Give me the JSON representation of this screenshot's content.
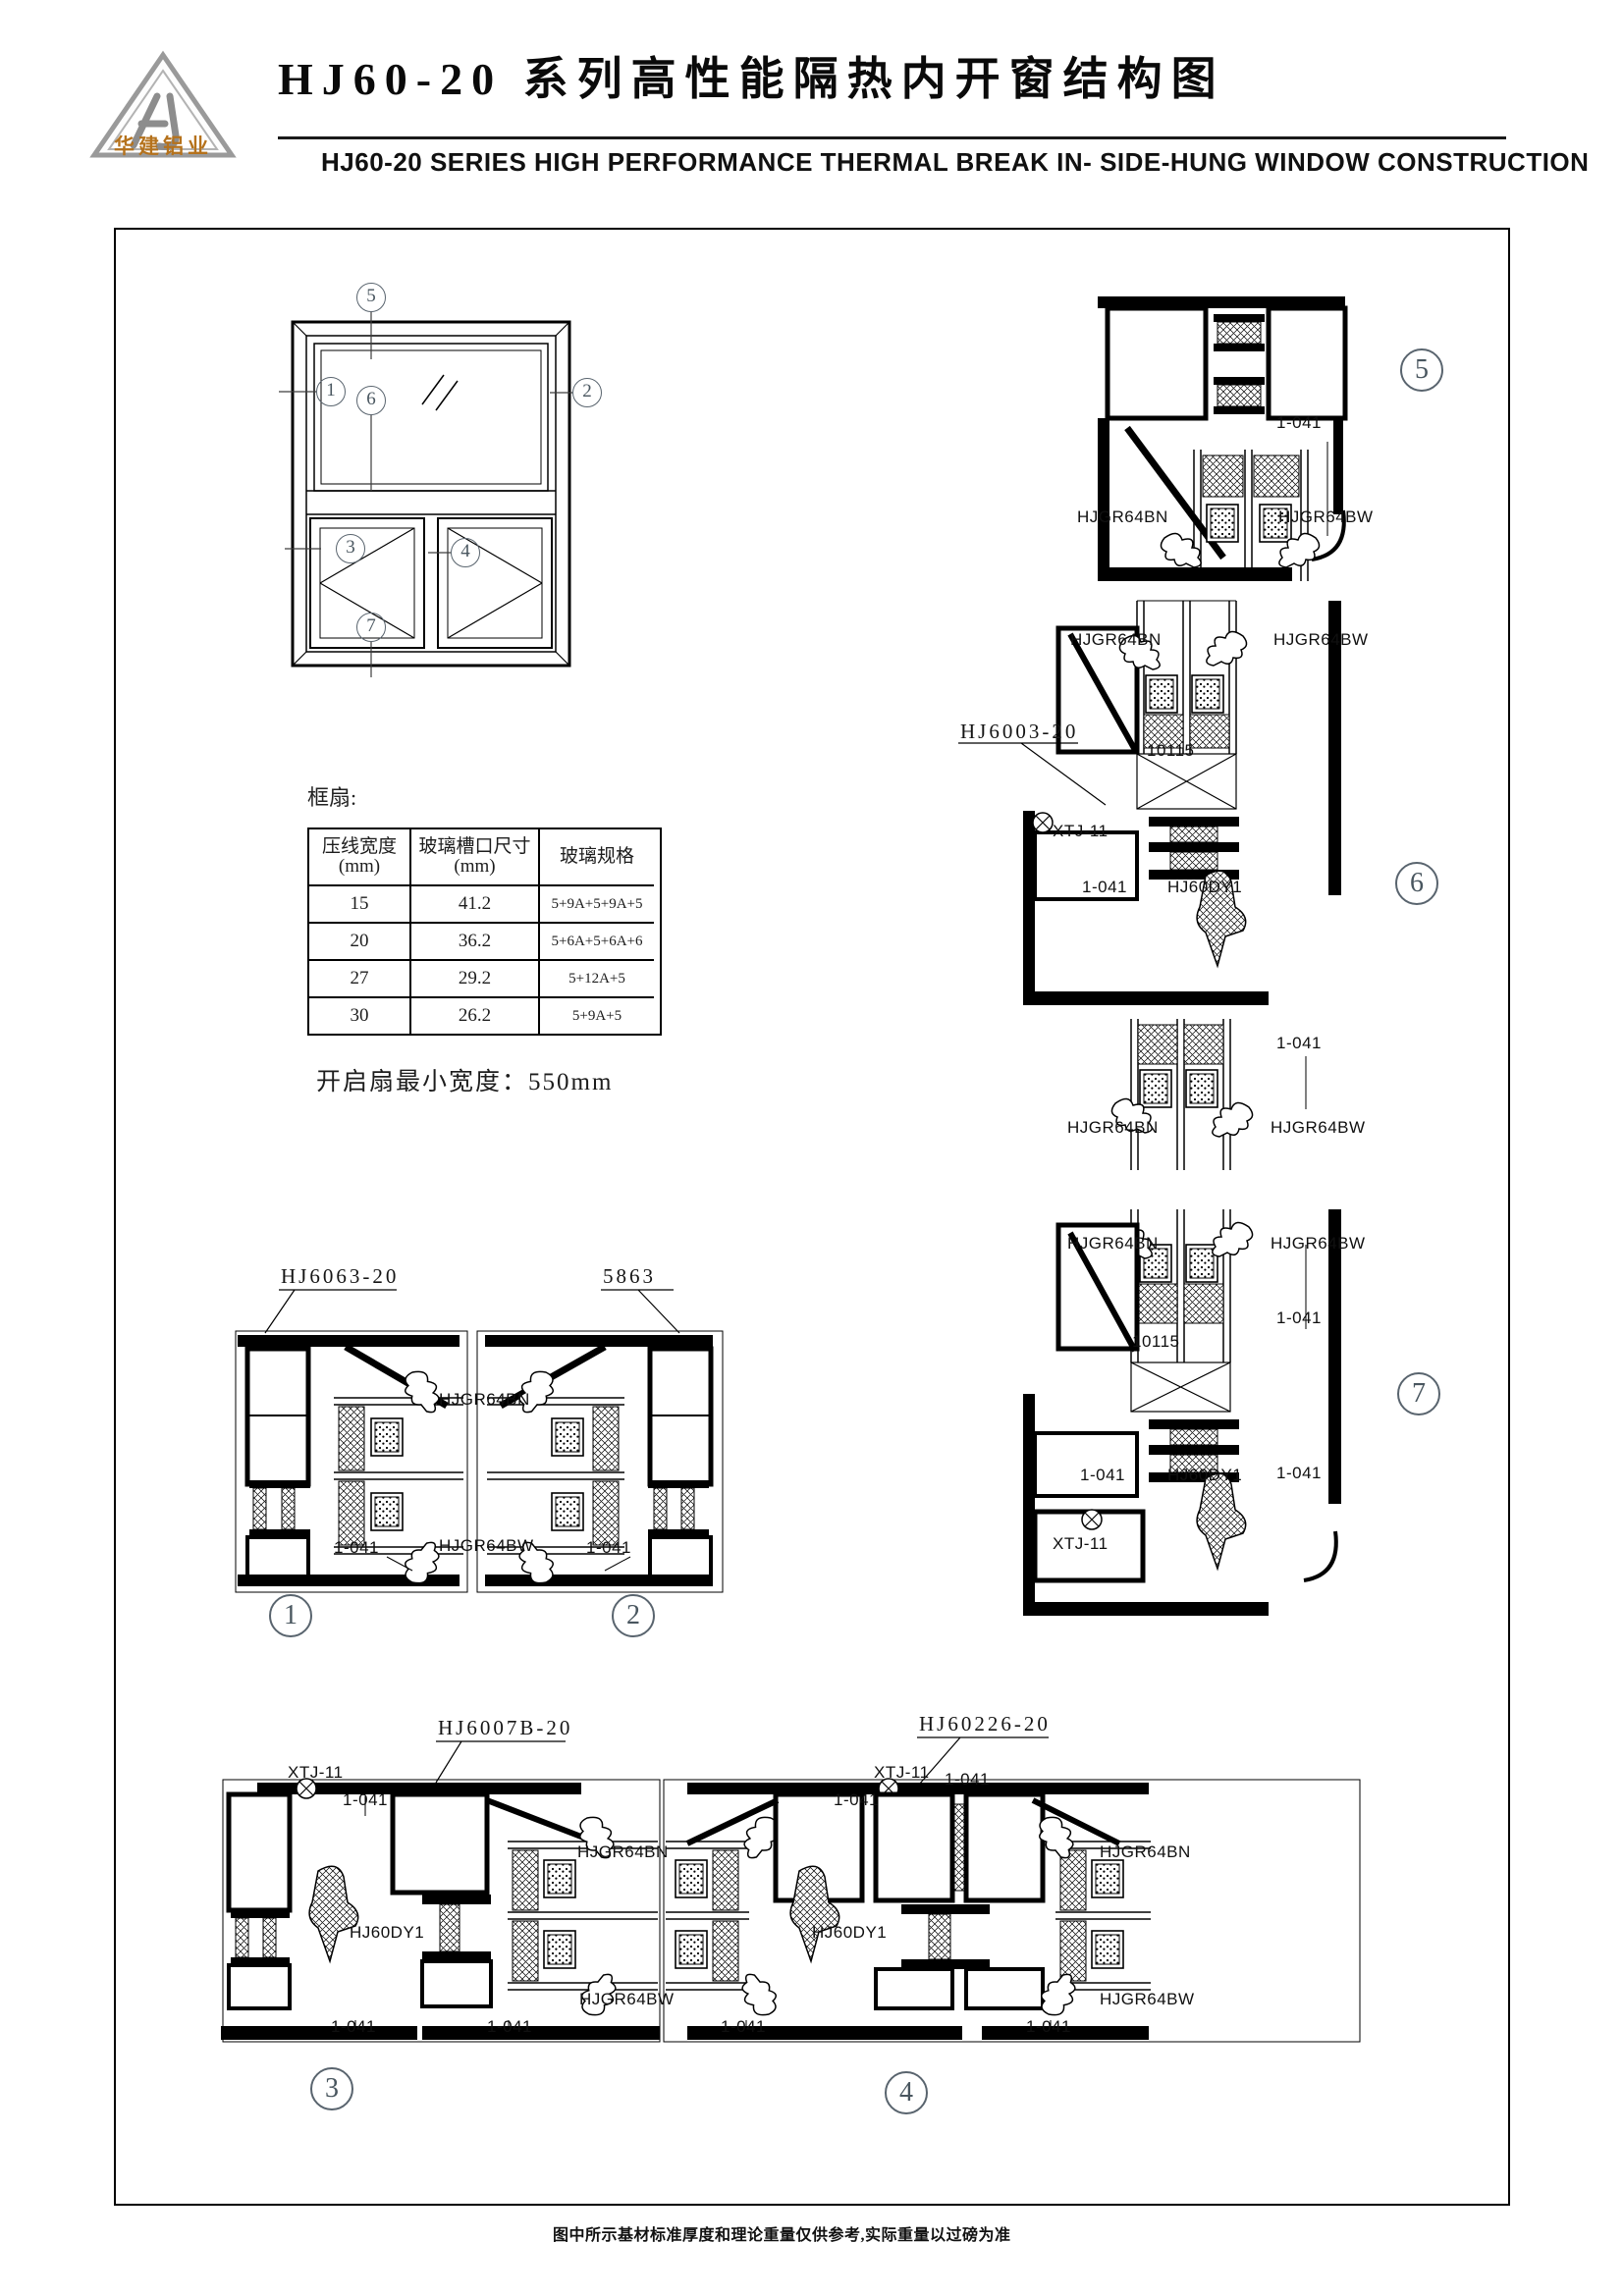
{
  "colors": {
    "ink": "#000000",
    "logo_accent": "#b5721c",
    "callout": "#4b5761"
  },
  "header": {
    "logo_monogram": "HJ",
    "logo_caption": "华建铝业",
    "title_cn": "HJ60-20 系列高性能隔热内开窗结构图",
    "title_en": "HJ60-20 SERIES HIGH PERFORMANCE THERMAL BREAK IN- SIDE-HUNG WINDOW CONSTRUCTION"
  },
  "elevation_callouts": {
    "c1": "1",
    "c2": "2",
    "c3": "3",
    "c4": "4",
    "c5": "5",
    "c6": "6",
    "c7": "7"
  },
  "detail_callouts": {
    "c1": "1",
    "c2": "2",
    "c3": "3",
    "c4": "4",
    "c5": "5",
    "c6": "6",
    "c7": "7"
  },
  "spec_table": {
    "section_label": "框扇:",
    "headers": [
      {
        "title": "压线宽度",
        "unit": "(mm)"
      },
      {
        "title": "玻璃槽口尺寸",
        "unit": "(mm)"
      },
      {
        "title": "玻璃规格",
        "unit": ""
      }
    ],
    "rows": [
      [
        "15",
        "41.2",
        "5+9A+5+9A+5"
      ],
      [
        "20",
        "36.2",
        "5+6A+5+6A+6"
      ],
      [
        "27",
        "29.2",
        "5+12A+5"
      ],
      [
        "30",
        "26.2",
        "5+9A+5"
      ]
    ]
  },
  "notes": {
    "min_sash_width": "开启扇最小宽度：550mm",
    "footer": "图中所示基材标准厚度和理论重量仅供参考,实际重量以过磅为准"
  },
  "annotations": [
    "HJ6063-20",
    "5863",
    "HJGR64BN",
    "1-041",
    "HJGR64BW",
    "1-041",
    "HJ6007B-20",
    "XTJ-11",
    "1-041",
    "HJ60DY1",
    "HJGR64BN",
    "HJGR64BW",
    "1-041",
    "1-041",
    "HJ60226-20",
    "XTJ-11",
    "1-041",
    "1-041",
    "HJ60DY1",
    "HJGR64BN",
    "HJGR64BW",
    "1-041",
    "1-041",
    "1-041",
    "HJGR64BN",
    "HJGR64BW",
    "HJGR64BN",
    "HJGR64BW",
    "HJ6003-20",
    "10115",
    "XTJ-11",
    "1-041",
    "HJ60DY1",
    "1-041",
    "HJGR64BN",
    "HJGR64BW",
    "HJGR64BN",
    "HJGR64BW",
    "1-041",
    "10115",
    "1-041",
    "HJ60DY1",
    "1-041",
    "XTJ-11"
  ]
}
